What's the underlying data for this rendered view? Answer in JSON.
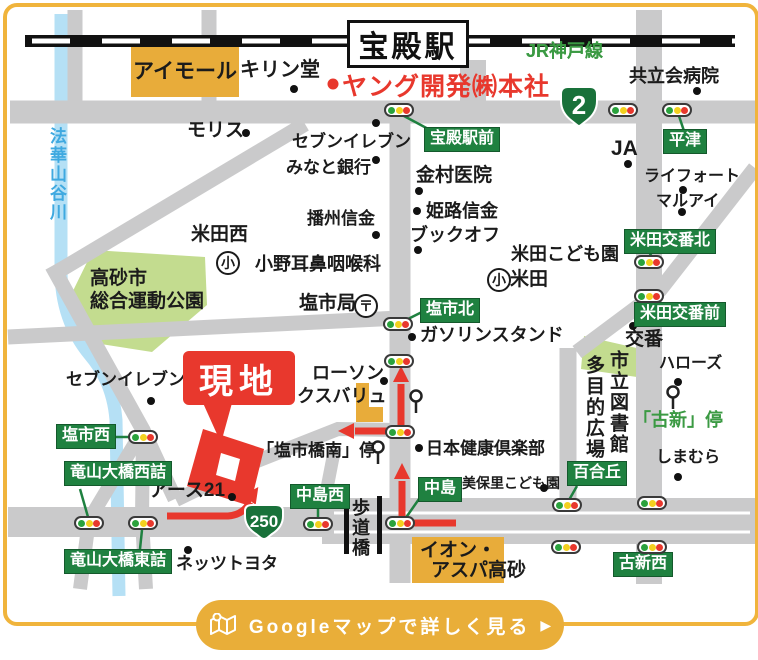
{
  "station": {
    "name": "宝殿駅"
  },
  "railway": {
    "label": "JR神戸線"
  },
  "company": {
    "label": "ヤング開発㈱本社"
  },
  "site": {
    "label": "現地"
  },
  "badges": [
    {
      "num": "2",
      "x": 557,
      "y": 84
    },
    {
      "num": "250",
      "x": 241,
      "y": 502
    }
  ],
  "button": {
    "label": "Googleマップで詳しく見る",
    "arrow": "▶",
    "icon": "map-icon"
  },
  "park": {
    "line1": "高砂市",
    "line2": "総合運動公園"
  },
  "ion": {
    "line1": "イオン・",
    "line2": "アスパ高砂"
  },
  "aimall": {
    "label": "アイモール"
  },
  "signal_boxes": [
    {
      "label": "宝殿駅前",
      "x": 424,
      "y": 127
    },
    {
      "label": "平津",
      "x": 663,
      "y": 129
    },
    {
      "label": "米田交番北",
      "x": 624,
      "y": 229
    },
    {
      "label": "米田交番前",
      "x": 634,
      "y": 302
    },
    {
      "label": "塩市北",
      "x": 420,
      "y": 298
    },
    {
      "label": "塩市西",
      "x": 56,
      "y": 424
    },
    {
      "label": "竜山大橋西詰",
      "x": 64,
      "y": 461
    },
    {
      "label": "竜山大橋東詰",
      "x": 64,
      "y": 549
    },
    {
      "label": "中島西",
      "x": 290,
      "y": 484
    },
    {
      "label": "中島",
      "x": 418,
      "y": 477
    },
    {
      "label": "百合丘",
      "x": 567,
      "y": 461
    },
    {
      "label": "古新西",
      "x": 613,
      "y": 552
    }
  ],
  "signals": [
    {
      "name": "signal-hoden-ekimae",
      "x": 399,
      "y": 110
    },
    {
      "name": "signal-r2-east",
      "x": 623,
      "y": 110
    },
    {
      "name": "signal-hiratsu",
      "x": 677,
      "y": 110
    },
    {
      "name": "signal-yoneda-koban-kita",
      "x": 649,
      "y": 262
    },
    {
      "name": "signal-yoneda-koban-mae",
      "x": 649,
      "y": 296
    },
    {
      "name": "signal-shioichi-kita",
      "x": 398,
      "y": 324
    },
    {
      "name": "signal-lawson-corner",
      "x": 399,
      "y": 361
    },
    {
      "name": "signal-shioichi-nishi",
      "x": 143,
      "y": 437
    },
    {
      "name": "signal-shioichibashi-minami",
      "x": 400,
      "y": 432
    },
    {
      "name": "signal-tatsuyama-nishizume",
      "x": 89,
      "y": 523
    },
    {
      "name": "signal-tatsuyama-higashizume",
      "x": 143,
      "y": 523
    },
    {
      "name": "signal-nakajima-nishi",
      "x": 318,
      "y": 524
    },
    {
      "name": "signal-nakajima",
      "x": 400,
      "y": 523
    },
    {
      "name": "signal-yurigaoka",
      "x": 567,
      "y": 505
    },
    {
      "name": "signal-wide-road-east",
      "x": 652,
      "y": 503
    },
    {
      "name": "signal-south-center",
      "x": 566,
      "y": 547
    },
    {
      "name": "signal-koshin-nishi",
      "x": 652,
      "y": 547
    }
  ],
  "poi": [
    {
      "label": "キリン堂",
      "x": 240,
      "y": 59,
      "size": 20,
      "dot": [
        294,
        89
      ]
    },
    {
      "label": "共立会病院",
      "x": 629,
      "y": 67,
      "size": 18,
      "dot": [
        697,
        91
      ]
    },
    {
      "label": "JA",
      "x": 611,
      "y": 137,
      "size": 21,
      "dot": [
        628,
        164
      ]
    },
    {
      "label": "ライフォート",
      "x": 644,
      "y": 168,
      "size": 16,
      "dot": [
        683,
        190
      ]
    },
    {
      "label": "マルアイ",
      "x": 656,
      "y": 193,
      "size": 16,
      "dot": [
        682,
        212
      ]
    },
    {
      "label": "モリス",
      "x": 187,
      "y": 121,
      "size": 19,
      "dot": [
        246,
        133
      ]
    },
    {
      "label": "セブンイレブン",
      "x": 292,
      "y": 133,
      "size": 17,
      "dot": [
        376,
        123
      ]
    },
    {
      "label": "みなと銀行",
      "x": 286,
      "y": 159,
      "size": 17,
      "dot": [
        376,
        160
      ]
    },
    {
      "label": "金村医院",
      "x": 416,
      "y": 166,
      "size": 19,
      "dot": [
        419,
        191
      ]
    },
    {
      "label": "姫路信金",
      "x": 426,
      "y": 202,
      "size": 18,
      "dot": [
        417,
        211
      ]
    },
    {
      "label": "播州信金",
      "x": 307,
      "y": 210,
      "size": 17,
      "dot": [
        376,
        235
      ]
    },
    {
      "label": "ブックオフ",
      "x": 410,
      "y": 226,
      "size": 18,
      "dot": [
        418,
        250
      ]
    },
    {
      "label": "米田西",
      "x": 191,
      "y": 225,
      "size": 19
    },
    {
      "label": "小野耳鼻咽喉科",
      "x": 255,
      "y": 255,
      "size": 18
    },
    {
      "label": "塩市局",
      "x": 299,
      "y": 294,
      "size": 19
    },
    {
      "label": "米田こども園",
      "x": 511,
      "y": 245,
      "size": 18
    },
    {
      "label": "米田",
      "x": 510,
      "y": 270,
      "size": 19
    },
    {
      "label": "ガソリンスタンド",
      "x": 420,
      "y": 326,
      "size": 18,
      "dot": [
        412,
        337
      ]
    },
    {
      "label": "交番",
      "x": 625,
      "y": 330,
      "size": 19,
      "dot": [
        633,
        326
      ]
    },
    {
      "label": "ハローズ",
      "x": 659,
      "y": 355,
      "size": 16,
      "dot": [
        678,
        382
      ]
    },
    {
      "label": "ローソン",
      "x": 312,
      "y": 364,
      "size": 18,
      "dot": [
        384,
        381
      ]
    },
    {
      "label": "マックスバリュ",
      "x": 261,
      "y": 387,
      "size": 18
    },
    {
      "label": "セブンイレブン",
      "x": 66,
      "y": 371,
      "size": 17,
      "dot": [
        151,
        401
      ]
    },
    {
      "label": "「塩市橋南」停",
      "x": 257,
      "y": 442,
      "size": 17
    },
    {
      "label": "日本健康倶楽部",
      "x": 426,
      "y": 440,
      "size": 17,
      "dot": [
        419,
        448
      ]
    },
    {
      "label": "アース21",
      "x": 149,
      "y": 481,
      "size": 19,
      "dot": [
        232,
        497
      ]
    },
    {
      "label": "美保里こども園",
      "x": 462,
      "y": 476,
      "size": 14,
      "dot": [
        544,
        488
      ]
    },
    {
      "label": "しまむら",
      "x": 656,
      "y": 449,
      "size": 16,
      "dot": [
        678,
        477
      ]
    },
    {
      "label": "ネッツトヨタ",
      "x": 176,
      "y": 555,
      "size": 17,
      "dot": [
        188,
        550
      ]
    }
  ],
  "green_texts": [
    {
      "label": "JR神戸線",
      "x": 526,
      "y": 42,
      "size": 18
    },
    {
      "label": "「古新」停",
      "x": 633,
      "y": 411,
      "size": 18
    }
  ],
  "vertical_texts": [
    {
      "label": "法華山谷川",
      "x": 48,
      "y": 127,
      "size": 17,
      "color": "blue"
    },
    {
      "label": "市立図書館",
      "x": 608,
      "y": 350,
      "size": 19
    },
    {
      "label": "多目的広場",
      "x": 584,
      "y": 355,
      "size": 19
    },
    {
      "label": "歩道橋",
      "x": 351,
      "y": 498,
      "size": 18
    }
  ],
  "circled": [
    {
      "ch": "小",
      "x": 216,
      "y": 251
    },
    {
      "ch": "小",
      "x": 487,
      "y": 268
    },
    {
      "ch": "〒",
      "x": 354,
      "y": 294
    }
  ],
  "colors": {
    "amber": "#E8AC3A",
    "frame": "#F0B43C",
    "green_box": "#1F8140",
    "badge_green": "#19713A",
    "red": "#E8382D",
    "road": "#CACACB",
    "river": "#B5E0F5",
    "park": "#C3DC8F",
    "green_text": "#3B9A43",
    "blue_text": "#3FA9E0"
  }
}
